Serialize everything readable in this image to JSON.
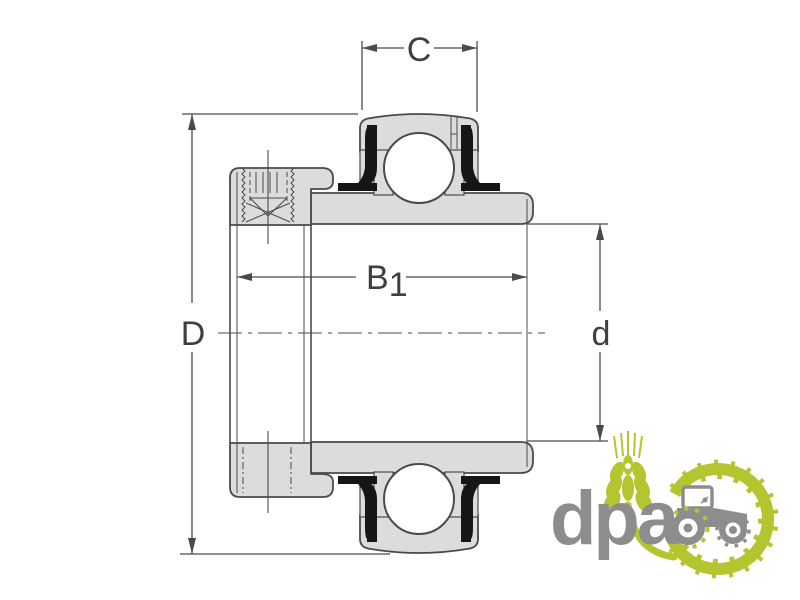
{
  "drawing": {
    "type": "insert-bearing-cross-section",
    "dimension_labels": {
      "width_c": "C",
      "outer_diameter": "D",
      "bore_diameter": "d",
      "total_width_base": "B",
      "total_width_sub": "1"
    },
    "colors": {
      "part_fill": "#dcdcdc",
      "line": "#4a4a4a",
      "label": "#3f3f3f",
      "seal": "#161616"
    }
  },
  "logo": {
    "text": "dpa",
    "text_color": "#8d8d8d",
    "green": "#b5c52f",
    "icons": [
      "wheat-icon",
      "tractor-icon",
      "gear-tire-icon"
    ]
  }
}
